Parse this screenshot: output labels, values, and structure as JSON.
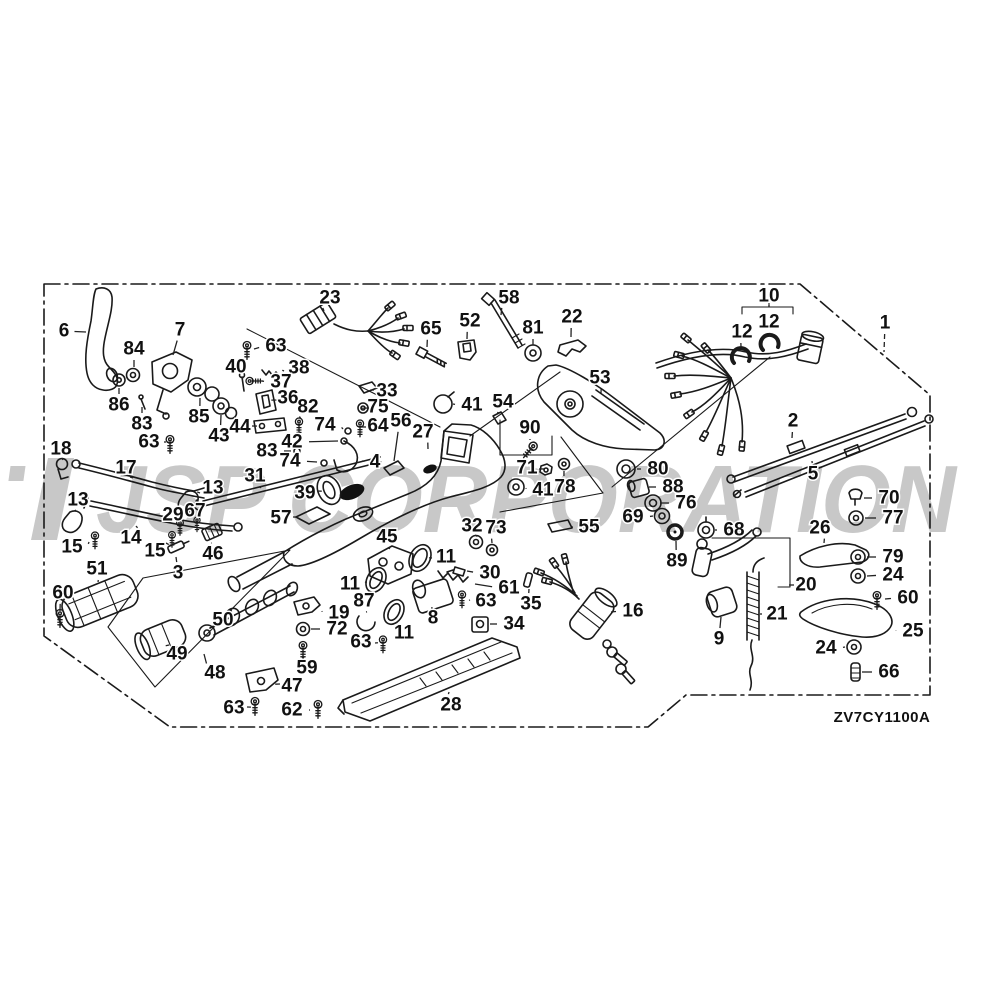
{
  "watermark": {
    "text": "JSP CORPORATION",
    "color": "#c8c8c8"
  },
  "diagram": {
    "code": "ZV7CY1100A",
    "line_color": "#1a1a1a",
    "background": "#ffffff"
  },
  "callouts": [
    {
      "t": "6",
      "x": 64,
      "y": 331,
      "lx": 86,
      "ly": 332
    },
    {
      "t": "84",
      "x": 134,
      "y": 349,
      "lx": 134,
      "ly": 367
    },
    {
      "t": "7",
      "x": 180,
      "y": 330,
      "lx": 173,
      "ly": 355
    },
    {
      "t": "63",
      "x": 276,
      "y": 346,
      "lx": 254,
      "ly": 349
    },
    {
      "t": "23",
      "x": 330,
      "y": 298,
      "lx": 324,
      "ly": 311
    },
    {
      "t": "65",
      "x": 431,
      "y": 329,
      "lx": 427,
      "ly": 347
    },
    {
      "t": "52",
      "x": 470,
      "y": 321,
      "lx": 467,
      "ly": 339
    },
    {
      "t": "58",
      "x": 509,
      "y": 298,
      "lx": 501,
      "ly": 315
    },
    {
      "t": "81",
      "x": 533,
      "y": 328,
      "lx": 533,
      "ly": 345
    },
    {
      "t": "22",
      "x": 572,
      "y": 317,
      "lx": 571,
      "ly": 337
    },
    {
      "t": "10",
      "x": 769,
      "y": 296,
      "lx": 769,
      "ly": 305
    },
    {
      "t": "12",
      "x": 769,
      "y": 322,
      "lx": 770,
      "ly": 336
    },
    {
      "t": "12",
      "x": 742,
      "y": 332,
      "lx": 741,
      "ly": 347
    },
    {
      "t": "1",
      "x": 885,
      "y": 323,
      "lx": 884,
      "ly": 352,
      "dash": true
    },
    {
      "t": "40",
      "x": 236,
      "y": 367,
      "lx": 242,
      "ly": 379
    },
    {
      "t": "38",
      "x": 299,
      "y": 368,
      "lx": 284,
      "ly": 371
    },
    {
      "t": "37",
      "x": 281,
      "y": 382,
      "lx": 262,
      "ly": 381
    },
    {
      "t": "36",
      "x": 288,
      "y": 398,
      "lx": 278,
      "ly": 400
    },
    {
      "t": "86",
      "x": 119,
      "y": 405,
      "lx": 119,
      "ly": 388
    },
    {
      "t": "85",
      "x": 199,
      "y": 417,
      "lx": 200,
      "ly": 398
    },
    {
      "t": "83",
      "x": 142,
      "y": 424,
      "lx": 142,
      "ly": 407
    },
    {
      "t": "43",
      "x": 219,
      "y": 436,
      "lx": 221,
      "ly": 415
    },
    {
      "t": "44",
      "x": 240,
      "y": 427,
      "lx": 252,
      "ly": 426
    },
    {
      "t": "63",
      "x": 149,
      "y": 442,
      "lx": 164,
      "ly": 442
    },
    {
      "t": "82",
      "x": 308,
      "y": 407,
      "lx": 301,
      "ly": 419
    },
    {
      "t": "42",
      "x": 292,
      "y": 442,
      "lx": 338,
      "ly": 441
    },
    {
      "t": "74",
      "x": 325,
      "y": 425,
      "lx": 343,
      "ly": 429
    },
    {
      "t": "83",
      "x": 267,
      "y": 451,
      "lx": 291,
      "ly": 451
    },
    {
      "t": "74",
      "x": 290,
      "y": 461,
      "lx": 317,
      "ly": 462
    },
    {
      "t": "33",
      "x": 387,
      "y": 391,
      "lx": 374,
      "ly": 390
    },
    {
      "t": "75",
      "x": 378,
      "y": 407,
      "lx": 369,
      "ly": 408
    },
    {
      "t": "64",
      "x": 378,
      "y": 426,
      "lx": 366,
      "ly": 427
    },
    {
      "t": "56",
      "x": 401,
      "y": 421,
      "lx": 394,
      "ly": 461
    },
    {
      "t": "27",
      "x": 423,
      "y": 432,
      "lx": 428,
      "ly": 449
    },
    {
      "t": "41",
      "x": 472,
      "y": 405,
      "lx": 453,
      "ly": 404
    },
    {
      "t": "54",
      "x": 503,
      "y": 402,
      "lx": 499,
      "ly": 413
    },
    {
      "t": "90",
      "x": 530,
      "y": 428,
      "lx": 530,
      "ly": 440
    },
    {
      "t": "53",
      "x": 600,
      "y": 378,
      "lx": 601,
      "ly": 393
    },
    {
      "t": "2",
      "x": 793,
      "y": 421,
      "lx": 792,
      "ly": 438
    },
    {
      "t": "4",
      "x": 375,
      "y": 462,
      "lx": 362,
      "ly": 461
    },
    {
      "t": "18",
      "x": 61,
      "y": 449,
      "lx": 62,
      "ly": 458
    },
    {
      "t": "17",
      "x": 126,
      "y": 468,
      "lx": 130,
      "ly": 477
    },
    {
      "t": "13",
      "x": 213,
      "y": 488,
      "lx": 200,
      "ly": 493
    },
    {
      "t": "13",
      "x": 78,
      "y": 500,
      "lx": 76,
      "ly": 510
    },
    {
      "t": "31",
      "x": 255,
      "y": 476,
      "lx": 260,
      "ly": 488
    },
    {
      "t": "39",
      "x": 305,
      "y": 493,
      "lx": 317,
      "ly": 491
    },
    {
      "t": "57",
      "x": 281,
      "y": 518,
      "lx": 293,
      "ly": 517
    },
    {
      "t": "71",
      "x": 527,
      "y": 468,
      "lx": 539,
      "ly": 469
    },
    {
      "t": "78",
      "x": 565,
      "y": 487,
      "lx": 564,
      "ly": 471
    },
    {
      "t": "41",
      "x": 543,
      "y": 490,
      "lx": 526,
      "ly": 488
    },
    {
      "t": "80",
      "x": 658,
      "y": 469,
      "lx": 637,
      "ly": 469
    },
    {
      "t": "88",
      "x": 673,
      "y": 487,
      "lx": 649,
      "ly": 487
    },
    {
      "t": "76",
      "x": 686,
      "y": 503,
      "lx": 660,
      "ly": 503
    },
    {
      "t": "69",
      "x": 633,
      "y": 517,
      "lx": 653,
      "ly": 516
    },
    {
      "t": "68",
      "x": 734,
      "y": 530,
      "lx": 715,
      "ly": 530
    },
    {
      "t": "55",
      "x": 589,
      "y": 527,
      "lx": 573,
      "ly": 527
    },
    {
      "t": "89",
      "x": 677,
      "y": 561,
      "lx": 676,
      "ly": 541
    },
    {
      "t": "5",
      "x": 813,
      "y": 474,
      "lx": 812,
      "ly": 461
    },
    {
      "t": "70",
      "x": 889,
      "y": 498,
      "lx": 864,
      "ly": 498
    },
    {
      "t": "77",
      "x": 893,
      "y": 518,
      "lx": 865,
      "ly": 518
    },
    {
      "t": "26",
      "x": 820,
      "y": 528,
      "lx": 824,
      "ly": 543
    },
    {
      "t": "79",
      "x": 893,
      "y": 557,
      "lx": 867,
      "ly": 557
    },
    {
      "t": "24",
      "x": 893,
      "y": 575,
      "lx": 867,
      "ly": 576
    },
    {
      "t": "20",
      "x": 806,
      "y": 585,
      "lx": 794,
      "ly": 585
    },
    {
      "t": "21",
      "x": 777,
      "y": 614,
      "lx": 762,
      "ly": 614
    },
    {
      "t": "9",
      "x": 719,
      "y": 639,
      "lx": 721,
      "ly": 617
    },
    {
      "t": "16",
      "x": 633,
      "y": 611,
      "lx": 611,
      "ly": 612
    },
    {
      "t": "35",
      "x": 531,
      "y": 604,
      "lx": 529,
      "ly": 589
    },
    {
      "t": "60",
      "x": 908,
      "y": 598,
      "lx": 885,
      "ly": 599
    },
    {
      "t": "25",
      "x": 913,
      "y": 631,
      "lx": 896,
      "ly": 630
    },
    {
      "t": "24",
      "x": 826,
      "y": 648,
      "lx": 845,
      "ly": 647
    },
    {
      "t": "66",
      "x": 889,
      "y": 672,
      "lx": 862,
      "ly": 672
    },
    {
      "t": "15",
      "x": 72,
      "y": 547,
      "lx": 89,
      "ly": 542
    },
    {
      "t": "14",
      "x": 131,
      "y": 538,
      "lx": 136,
      "ly": 526
    },
    {
      "t": "29",
      "x": 173,
      "y": 515,
      "lx": 179,
      "ly": 524
    },
    {
      "t": "67",
      "x": 195,
      "y": 511,
      "lx": 197,
      "ly": 521
    },
    {
      "t": "15",
      "x": 155,
      "y": 551,
      "lx": 166,
      "ly": 543
    },
    {
      "t": "3",
      "x": 178,
      "y": 573,
      "lx": 176,
      "ly": 557
    },
    {
      "t": "46",
      "x": 213,
      "y": 554,
      "lx": 212,
      "ly": 543
    },
    {
      "t": "51",
      "x": 97,
      "y": 569,
      "lx": 98,
      "ly": 582
    },
    {
      "t": "60",
      "x": 63,
      "y": 593,
      "lx": 60,
      "ly": 611
    },
    {
      "t": "45",
      "x": 387,
      "y": 537,
      "lx": 389,
      "ly": 549
    },
    {
      "t": "32",
      "x": 472,
      "y": 526,
      "lx": 475,
      "ly": 535
    },
    {
      "t": "73",
      "x": 496,
      "y": 528,
      "lx": 492,
      "ly": 543
    },
    {
      "t": "11",
      "x": 446,
      "y": 557,
      "lx": 432,
      "ly": 558
    },
    {
      "t": "30",
      "x": 490,
      "y": 573,
      "lx": 467,
      "ly": 571
    },
    {
      "t": "61",
      "x": 509,
      "y": 588,
      "lx": 475,
      "ly": 584
    },
    {
      "t": "63",
      "x": 486,
      "y": 601,
      "lx": 470,
      "ly": 600
    },
    {
      "t": "11",
      "x": 350,
      "y": 584,
      "lx": 365,
      "ly": 582
    },
    {
      "t": "87",
      "x": 364,
      "y": 601,
      "lx": 366,
      "ly": 612
    },
    {
      "t": "19",
      "x": 339,
      "y": 613,
      "lx": 322,
      "ly": 611
    },
    {
      "t": "72",
      "x": 337,
      "y": 629,
      "lx": 311,
      "ly": 629
    },
    {
      "t": "63",
      "x": 361,
      "y": 642,
      "lx": 375,
      "ly": 643
    },
    {
      "t": "8",
      "x": 433,
      "y": 618,
      "lx": 432,
      "ly": 609
    },
    {
      "t": "11",
      "x": 404,
      "y": 633,
      "lx": 398,
      "ly": 621
    },
    {
      "t": "34",
      "x": 514,
      "y": 624,
      "lx": 490,
      "ly": 624
    },
    {
      "t": "50",
      "x": 223,
      "y": 620,
      "lx": 228,
      "ly": 612
    },
    {
      "t": "49",
      "x": 177,
      "y": 654,
      "lx": 169,
      "ly": 645
    },
    {
      "t": "48",
      "x": 215,
      "y": 673,
      "lx": 204,
      "ly": 654
    },
    {
      "t": "59",
      "x": 307,
      "y": 668,
      "lx": 304,
      "ly": 658
    },
    {
      "t": "47",
      "x": 292,
      "y": 686,
      "lx": 280,
      "ly": 684
    },
    {
      "t": "63",
      "x": 234,
      "y": 708,
      "lx": 247,
      "ly": 707
    },
    {
      "t": "62",
      "x": 292,
      "y": 710,
      "lx": 310,
      "ly": 710
    },
    {
      "t": "28",
      "x": 451,
      "y": 705,
      "lx": 449,
      "ly": 692
    }
  ]
}
